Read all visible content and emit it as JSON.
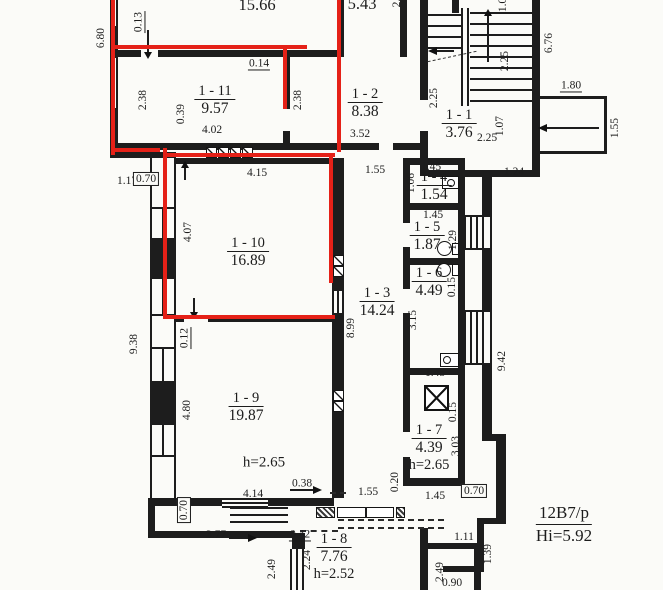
{
  "title": "apartment-floor-plan-scan",
  "colors": {
    "highlight_red": "#e52118",
    "ink": "#1d1d1d",
    "paper": "#fbfbf8"
  },
  "note": {
    "top_text": "12В7/р",
    "bottom_text": "Hi=5.92"
  },
  "rooms": [
    {
      "number": "",
      "area": "15.66",
      "height": "",
      "x": 257,
      "y": -4
    },
    {
      "number": "",
      "area": "5.43",
      "height": "",
      "x": 362,
      "y": -5
    },
    {
      "number": "1 - 11",
      "area": "9.57",
      "height": "",
      "x": 215,
      "y": 82
    },
    {
      "number": "1 - 2",
      "area": "8.38",
      "height": "",
      "x": 365,
      "y": 85
    },
    {
      "number": "1 - 1",
      "area": "3.76",
      "height": "",
      "x": 459,
      "y": 106
    },
    {
      "number": "1 - 10",
      "area": "16.89",
      "height": "",
      "x": 248,
      "y": 234
    },
    {
      "number": "1 - 3",
      "area": "14.24",
      "height": "",
      "x": 377,
      "y": 284
    },
    {
      "number": "1 - 4",
      "area": "1.54",
      "height": "",
      "x": 434,
      "y": 168
    },
    {
      "number": "1 - 5",
      "area": "1.87",
      "height": "",
      "x": 427,
      "y": 218
    },
    {
      "number": "1 - 6",
      "area": "4.49",
      "height": "",
      "x": 429,
      "y": 264
    },
    {
      "number": "1 - 9",
      "area": "19.87",
      "height": "",
      "x": 246,
      "y": 389
    },
    {
      "number": "1 - 7",
      "area": "4.39",
      "height": "h=2.65",
      "x": 429,
      "y": 421
    },
    {
      "number": "1 - 8",
      "area": "7.76",
      "height": "h=2.52",
      "x": 334,
      "y": 530
    }
  ],
  "floating_labels": [
    {
      "text": "h=2.65",
      "x": 264,
      "y": 463
    }
  ],
  "dimensions": [
    {
      "t": "6.80",
      "x": 101,
      "y": 38,
      "r": 1
    },
    {
      "t": "0.13",
      "x": 139,
      "y": 22,
      "r": 1,
      "u": 1
    },
    {
      "t": "2.",
      "x": 397,
      "y": 3,
      "r": 1
    },
    {
      "t": "0.14",
      "x": 259,
      "y": 64,
      "u": 1
    },
    {
      "t": "2.38",
      "x": 143,
      "y": 100,
      "r": 1
    },
    {
      "t": "0.39",
      "x": 181,
      "y": 114,
      "r": 1
    },
    {
      "t": "4.02",
      "x": 212,
      "y": 130
    },
    {
      "t": "2.38",
      "x": 298,
      "y": 100,
      "r": 1
    },
    {
      "t": "3.52",
      "x": 360,
      "y": 134
    },
    {
      "t": "2.25",
      "x": 434,
      "y": 98,
      "r": 1
    },
    {
      "t": "2.25",
      "x": 487,
      "y": 138
    },
    {
      "t": "1.07",
      "x": 500,
      "y": 126,
      "r": 1
    },
    {
      "t": "2.25",
      "x": 505,
      "y": 61,
      "r": 1
    },
    {
      "t": "6.76",
      "x": 549,
      "y": 43,
      "r": 1
    },
    {
      "t": "1.80",
      "x": 571,
      "y": 86,
      "u": 1
    },
    {
      "t": "1.55",
      "x": 615,
      "y": 128,
      "r": 1
    },
    {
      "t": "1.07",
      "x": 503,
      "y": 2,
      "r": 1
    },
    {
      "t": "1.24",
      "x": 514,
      "y": 172
    },
    {
      "t": "1.17",
      "x": 127,
      "y": 181
    },
    {
      "t": "0.70",
      "x": 146,
      "y": 179,
      "b": 1
    },
    {
      "t": "4.15",
      "x": 257,
      "y": 173
    },
    {
      "t": "1.55",
      "x": 375,
      "y": 170
    },
    {
      "t": "1.45",
      "x": 431,
      "y": 167
    },
    {
      "t": "1.06",
      "x": 411,
      "y": 183,
      "r": 1
    },
    {
      "t": "1.45",
      "x": 433,
      "y": 215
    },
    {
      "t": "1.29",
      "x": 453,
      "y": 240,
      "r": 1
    },
    {
      "t": "4.07",
      "x": 188,
      "y": 232,
      "r": 1
    },
    {
      "t": "0.15",
      "x": 452,
      "y": 287,
      "r": 1
    },
    {
      "t": "3.15",
      "x": 413,
      "y": 320,
      "r": 1
    },
    {
      "t": "8.99",
      "x": 351,
      "y": 328,
      "r": 1
    },
    {
      "t": "9.42",
      "x": 502,
      "y": 361,
      "r": 1
    },
    {
      "t": "9.38",
      "x": 134,
      "y": 344,
      "r": 1
    },
    {
      "t": "0.12",
      "x": 185,
      "y": 338,
      "r": 1,
      "u": 1
    },
    {
      "t": "4.80",
      "x": 187,
      "y": 410,
      "r": 1
    },
    {
      "t": "1.45",
      "x": 435,
      "y": 373
    },
    {
      "t": "0.15",
      "x": 453,
      "y": 412,
      "r": 1
    },
    {
      "t": "3.03",
      "x": 456,
      "y": 446,
      "r": 1
    },
    {
      "t": "1.45",
      "x": 435,
      "y": 496
    },
    {
      "t": "0.70",
      "x": 474,
      "y": 491,
      "b": 1
    },
    {
      "t": "4.14",
      "x": 253,
      "y": 494
    },
    {
      "t": "0.38",
      "x": 302,
      "y": 484,
      "u": 1
    },
    {
      "t": "1.55",
      "x": 368,
      "y": 492
    },
    {
      "t": "0.20",
      "x": 395,
      "y": 482,
      "r": 1
    },
    {
      "t": "3.77",
      "x": 216,
      "y": 535
    },
    {
      "t": "0.70",
      "x": 184,
      "y": 510,
      "r": 1,
      "b": 1
    },
    {
      "t": "0.42",
      "x": 300,
      "y": 535,
      "u": 1
    },
    {
      "t": "2.24",
      "x": 307,
      "y": 560,
      "r": 1
    },
    {
      "t": "2.49",
      "x": 272,
      "y": 569,
      "r": 1
    },
    {
      "t": "2.49",
      "x": 440,
      "y": 572,
      "r": 1
    },
    {
      "t": "0.90",
      "x": 452,
      "y": 583
    },
    {
      "t": "1.11",
      "x": 464,
      "y": 537
    },
    {
      "t": "1.39",
      "x": 488,
      "y": 554,
      "r": 1
    }
  ]
}
